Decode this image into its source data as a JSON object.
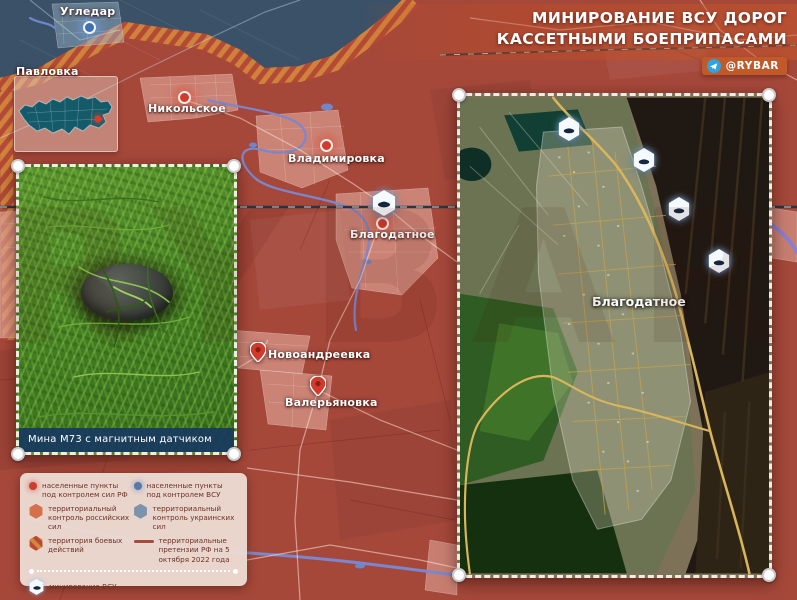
{
  "header": {
    "title_line1": "МИНИРОВАНИЕ ВСУ ДОРОГ",
    "title_line2": "КАССЕТНЫМИ БОЕПРИПАСАМИ",
    "brand_handle": "@RYBAR"
  },
  "watermark": "RYBAR",
  "map": {
    "cities": [
      {
        "name": "Угледар",
        "control": "afu",
        "marker": "circle"
      },
      {
        "name": "Павловка",
        "control": "rf",
        "marker": "none"
      },
      {
        "name": "Никольское",
        "control": "rf",
        "marker": "circle"
      },
      {
        "name": "Владимировка",
        "control": "rf",
        "marker": "circle"
      },
      {
        "name": "Благодатное",
        "control": "rf",
        "marker": "circle"
      },
      {
        "name": "Новоандреевка",
        "control": "rf",
        "marker": "pin"
      },
      {
        "name": "Валерьяновка",
        "control": "rf",
        "marker": "pin"
      }
    ],
    "mine_markers_on_map": 1
  },
  "insets": {
    "photo": {
      "caption": "Мина М73 с магнитным датчиком"
    },
    "satellite": {
      "label": "Благодатное",
      "mine_markers": 4
    }
  },
  "legend": {
    "items": [
      {
        "icon": "settlement-rf-dot-icon",
        "label": "населенные пункты под контролем сил РФ"
      },
      {
        "icon": "settlement-afu-dot-icon",
        "label": "населенные пункты под контролем ВСУ"
      },
      {
        "icon": "territory-rf-hex-icon",
        "label": "территориальный контроль российских сил"
      },
      {
        "icon": "territory-afu-hex-icon",
        "label": "территориальный контроль украинских сил"
      },
      {
        "icon": "combat-zone-hex-icon",
        "label": "территория боевых действий"
      },
      {
        "icon": "claims-line-icon",
        "label": "территориальные претензии РФ на 5 октября 2022 года"
      },
      {
        "icon": "mine-hex-icon",
        "label": "минирование ВСУ"
      }
    ]
  },
  "icons": {
    "telegram": "telegram-icon",
    "mine": "mine-icon",
    "settlement_dot": "settlement-dot-icon",
    "map_pin": "pin-marker-icon"
  },
  "colors": {
    "rf_territory": "#a5483a",
    "afu_territory": "#3a5168",
    "combat_hatch_orange": "#d0823c",
    "combat_hatch_red": "#b34a35",
    "settlement_rf_marker": "#d23b2a",
    "settlement_afu_marker": "#3f6fb5",
    "brand_bg": "#c2592a",
    "caption_bg": "#183a5f",
    "legend_bg": "#ecdbd2",
    "legend_text": "#6b3328",
    "river": "#7a87cf",
    "mine_glyph": "#14273e"
  }
}
